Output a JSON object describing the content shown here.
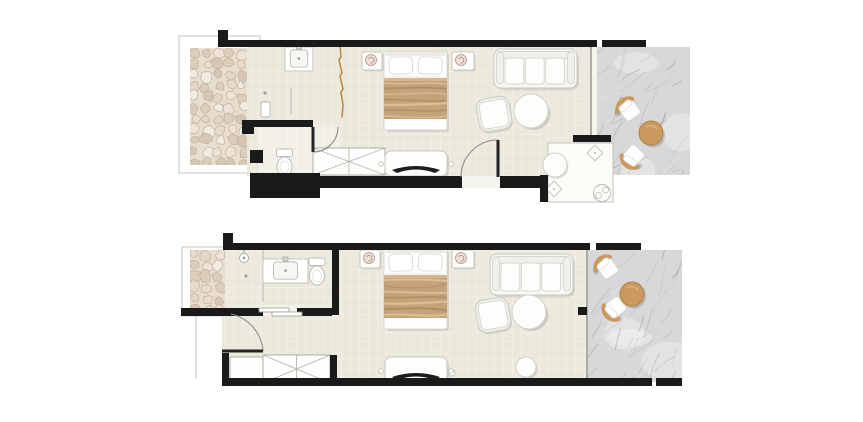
{
  "canvas": {
    "width": 863,
    "height": 422,
    "background": "#ffffff"
  },
  "palette": {
    "wall": "#1a1a1a",
    "floor": "#ebe8dc",
    "floor_light": "#f1efe6",
    "tile_line": "rgba(255,255,255,0.55)",
    "threshold": "#f6f5ef",
    "outline": "#c4c3bb",
    "pebble_bg": "#e8decf",
    "stones": [
      "#f2ebe2",
      "#e4d6c6",
      "#dccdbb",
      "#eee3d7",
      "#e9dccd",
      "#d7c6b3"
    ],
    "stone_line": "#c1b09e",
    "marble": "#d8d8da",
    "marble_veins": [
      "#a3a4aa",
      "#b9bac0",
      "#92939a",
      "#e6e6e8"
    ],
    "ext_floor": "#fbfbf8",
    "white": "#fdfdfc",
    "furn_stroke": "#c9c9c2",
    "cushion_stroke": "#d7d7d1",
    "back_fill": "#efefeb",
    "tan": "#c9995f",
    "tan_dark": "#b3813f",
    "tan_light": "#ddb27c",
    "blanket": "#c5a37a",
    "blanket_band": "#d4b78f",
    "blanket_dark": "rgba(166,128,84,0.6)",
    "blanket_light": "rgba(230,203,163,0.7)",
    "curtain": "#c18a48",
    "lamp_fill": "#ede2db",
    "lamp_stroke": "#c2a194",
    "tv": "#1d1d1d",
    "door_leaf": "#242424",
    "door_arc": "#8d8d87",
    "line_gray": "#b8b8b2",
    "window_line": "#9c9c96",
    "shadow": "rgba(0,0,0,0.10)"
  },
  "plans": [
    {
      "name": "upper-room-plan",
      "seed": 11,
      "items": [
        {
          "t": "outline",
          "name": "terrace-outline",
          "r": [
            179,
            36,
            81,
            137
          ]
        },
        {
          "t": "pebbles",
          "name": "pebble-paving",
          "r": [
            190,
            48,
            57,
            117
          ]
        },
        {
          "t": "floor",
          "name": "room-floor",
          "r": [
            247,
            47,
            343,
            129
          ]
        },
        {
          "t": "floor",
          "name": "toilet-room-floor",
          "r": [
            258,
            127,
            82,
            48
          ],
          "light": true
        },
        {
          "t": "wrect",
          "name": "terrace-threshold",
          "r": [
            590,
            47,
            7,
            129
          ]
        },
        {
          "t": "marble",
          "name": "marble-terrace",
          "r": [
            597,
            47,
            93,
            128
          ]
        },
        {
          "t": "ext",
          "name": "outdoor-shower-room",
          "r": [
            548,
            143,
            65,
            59
          ]
        },
        {
          "t": "wrect",
          "name": "entrance-threshold",
          "r": [
            462,
            176,
            38,
            12
          ]
        },
        {
          "t": "wline",
          "name": "terrace-window",
          "a": [
            591,
            47
          ],
          "b": [
            591,
            135
          ]
        },
        {
          "t": "sink",
          "name": "washbasin",
          "r": [
            285,
            47,
            28,
            24
          ]
        },
        {
          "t": "pline",
          "name": "shower-screen",
          "a": [
            291,
            88
          ],
          "b": [
            291,
            114
          ]
        },
        {
          "t": "minirect",
          "name": "shower-shelf",
          "r": [
            261,
            102,
            9,
            15
          ]
        },
        {
          "t": "dot",
          "name": "floor-drain",
          "c": [
            265,
            93
          ]
        },
        {
          "t": "toilet",
          "name": "toilet",
          "c": [
            284.5,
            149
          ]
        },
        {
          "t": "curtain",
          "name": "curtain-divider",
          "pts": [
            [
              340,
              44
            ],
            [
              341,
              57
            ],
            [
              339,
              60
            ],
            [
              342,
              73
            ],
            [
              340,
              76
            ],
            [
              343,
              89
            ],
            [
              341,
              92
            ],
            [
              343,
              105
            ],
            [
              342,
              117
            ]
          ]
        },
        {
          "t": "sidetable",
          "name": "nightstand-left",
          "r": [
            362,
            52,
            20,
            18
          ],
          "lamp": [
            371,
            60
          ]
        },
        {
          "t": "sidetable",
          "name": "nightstand-right",
          "r": [
            452,
            52,
            22,
            18
          ],
          "lamp": [
            461,
            60
          ]
        },
        {
          "t": "bed",
          "name": "double-bed",
          "r": [
            384,
            51,
            63,
            79
          ]
        },
        {
          "t": "sofa",
          "name": "sofa",
          "r": [
            494,
            49,
            83,
            39
          ]
        },
        {
          "t": "armchair",
          "name": "armchair",
          "c": [
            494,
            114
          ],
          "s": 29,
          "rot": -10
        },
        {
          "t": "rtable",
          "name": "coffee-table",
          "c": [
            531,
            111
          ],
          "r": 17
        },
        {
          "t": "stool",
          "name": "pouf",
          "c": [
            555,
            165
          ],
          "r": 12
        },
        {
          "t": "wardrobe",
          "name": "wardrobe",
          "r": [
            313,
            148,
            72,
            27
          ],
          "x2": true
        },
        {
          "t": "tv",
          "name": "tv-console",
          "r": [
            385,
            151,
            62,
            25
          ]
        },
        {
          "t": "diamond",
          "name": "spotlight",
          "c": [
            595,
            153
          ]
        },
        {
          "t": "diamond",
          "name": "spotlight",
          "c": [
            554,
            189
          ]
        },
        {
          "t": "fixture",
          "name": "outdoor-shower-fixture",
          "c": [
            602,
            193
          ]
        },
        {
          "t": "ochair",
          "name": "terrace-chair",
          "c": [
            630,
            111
          ],
          "rot": 48
        },
        {
          "t": "ochair",
          "name": "terrace-chair",
          "c": [
            634,
            155
          ],
          "rot": -55
        },
        {
          "t": "otable",
          "name": "terrace-table",
          "c": [
            651,
            133
          ],
          "r": 12
        },
        {
          "t": "walls",
          "name": "walls",
          "rects": [
            [
              218,
              30,
              10,
              17
            ],
            [
              218,
              40,
              379,
              7
            ],
            [
              602,
              40,
              44,
              7
            ],
            [
              242,
              120,
              71,
              7
            ],
            [
              242,
              120,
              12,
              14
            ],
            [
              250,
              150,
              13,
              13
            ],
            [
              250,
              173,
              70,
              25
            ],
            [
              320,
              176,
              142,
              12
            ],
            [
              500,
              176,
              46,
              12
            ],
            [
              540,
              175,
              8,
              27
            ],
            [
              573,
              135,
              38,
              7
            ]
          ]
        },
        {
          "t": "door",
          "name": "entrance-door",
          "leaf": [
            [
              498,
              140
            ],
            [
              498,
              177
            ]
          ],
          "arc": "M461,177 A37,37 0 0 1 498,140"
        },
        {
          "t": "door",
          "name": "toilet-door",
          "leaf": [
            [
              313,
              127
            ],
            [
              313,
              152
            ]
          ],
          "arc": "M338,127 A25,25 0 0 1 313,152"
        }
      ]
    },
    {
      "name": "lower-room-plan",
      "seed": 29,
      "items": [
        {
          "t": "outline",
          "name": "terrace-outline",
          "r": [
            182,
            247,
            58,
            69
          ]
        },
        {
          "t": "pebbles",
          "name": "pebble-paving",
          "r": [
            190,
            250,
            35,
            58
          ]
        },
        {
          "t": "floor",
          "name": "bathroom-floor",
          "r": [
            225,
            250,
            107,
            58
          ]
        },
        {
          "t": "floor",
          "name": "corridor-floor",
          "r": [
            222,
            316,
            117,
            62
          ]
        },
        {
          "t": "floor",
          "name": "room-floor",
          "r": [
            339,
            250,
            249,
            128
          ]
        },
        {
          "t": "marble",
          "name": "marble-terrace",
          "r": [
            588,
            250,
            94,
            132
          ]
        },
        {
          "t": "wrect",
          "name": "sliding-door-gap",
          "r": [
            259,
            306,
            42,
            10
          ]
        },
        {
          "t": "pline",
          "name": "entry-boundary",
          "a": [
            196,
            316
          ],
          "b": [
            196,
            378
          ],
          "light": true
        },
        {
          "t": "wline",
          "name": "terrace-window",
          "a": [
            587,
            250
          ],
          "b": [
            587,
            378
          ]
        },
        {
          "t": "shower",
          "name": "shower-head",
          "c": [
            244,
            258
          ]
        },
        {
          "t": "dot",
          "name": "floor-drain",
          "c": [
            246,
            276
          ]
        },
        {
          "t": "pline",
          "name": "shower-partition",
          "a": [
            263,
            250
          ],
          "b": [
            263,
            302
          ]
        },
        {
          "t": "sink",
          "name": "washbasin",
          "r": [
            263,
            259,
            45,
            24
          ]
        },
        {
          "t": "toilet",
          "name": "toilet",
          "c": [
            317,
            258
          ]
        },
        {
          "t": "sidetable",
          "name": "nightstand-left",
          "r": [
            360,
            250,
            20,
            18
          ],
          "lamp": [
            369,
            258
          ]
        },
        {
          "t": "sidetable",
          "name": "nightstand-right",
          "r": [
            452,
            250,
            22,
            18
          ],
          "lamp": [
            461,
            258
          ]
        },
        {
          "t": "bed",
          "name": "double-bed",
          "r": [
            384,
            248,
            63,
            81
          ]
        },
        {
          "t": "sofa",
          "name": "sofa",
          "r": [
            490,
            254,
            83,
            41
          ]
        },
        {
          "t": "armchair",
          "name": "armchair",
          "c": [
            493,
            315
          ],
          "s": 29,
          "rot": -10
        },
        {
          "t": "rtable",
          "name": "coffee-table",
          "c": [
            529,
            312
          ],
          "r": 17
        },
        {
          "t": "stool",
          "name": "pouf",
          "c": [
            526,
            367
          ],
          "r": 10
        },
        {
          "t": "dotc",
          "name": "floor-spot",
          "c": [
            452,
            373
          ],
          "rr": 3
        },
        {
          "t": "wardrobe",
          "name": "luggage-bench",
          "r": [
            230,
            357,
            33,
            24
          ],
          "x2": false
        },
        {
          "t": "wardrobe",
          "name": "wardrobe",
          "r": [
            263,
            355,
            67,
            28
          ],
          "x2": true
        },
        {
          "t": "tv",
          "name": "tv-console",
          "r": [
            385,
            357,
            62,
            26
          ]
        },
        {
          "t": "ochair",
          "name": "terrace-chair",
          "c": [
            608,
            269
          ],
          "rot": 47
        },
        {
          "t": "ochair",
          "name": "terrace-chair",
          "c": [
            616,
            307
          ],
          "rot": -45
        },
        {
          "t": "otable",
          "name": "terrace-table",
          "c": [
            632,
            294
          ],
          "r": 12
        },
        {
          "t": "walls",
          "name": "walls",
          "rects": [
            [
              223,
              233,
              10,
              17
            ],
            [
              223,
              243,
              367,
              7
            ],
            [
              596,
              243,
              45,
              7
            ],
            [
              332,
              243,
              7,
              72
            ],
            [
              181,
              308,
              82,
              8
            ],
            [
              297,
              308,
              35,
              8
            ],
            [
              222,
              353,
              7,
              26
            ],
            [
              222,
              378,
              430,
              8
            ],
            [
              656,
              378,
              26,
              8
            ],
            [
              330,
              355,
              7,
              23
            ],
            [
              578,
              307,
              9,
              8
            ]
          ]
        },
        {
          "t": "slider",
          "name": "sliding-door",
          "rects": [
            [
              259,
              308,
              30,
              4
            ],
            [
              272,
              312,
              30,
              4
            ]
          ]
        },
        {
          "t": "door",
          "name": "entrance-door",
          "leaf": [
            [
              222,
              351
            ],
            [
              263,
              351
            ]
          ],
          "arc": "M263,351 A41,41 0 0 0 231,314"
        }
      ]
    }
  ]
}
